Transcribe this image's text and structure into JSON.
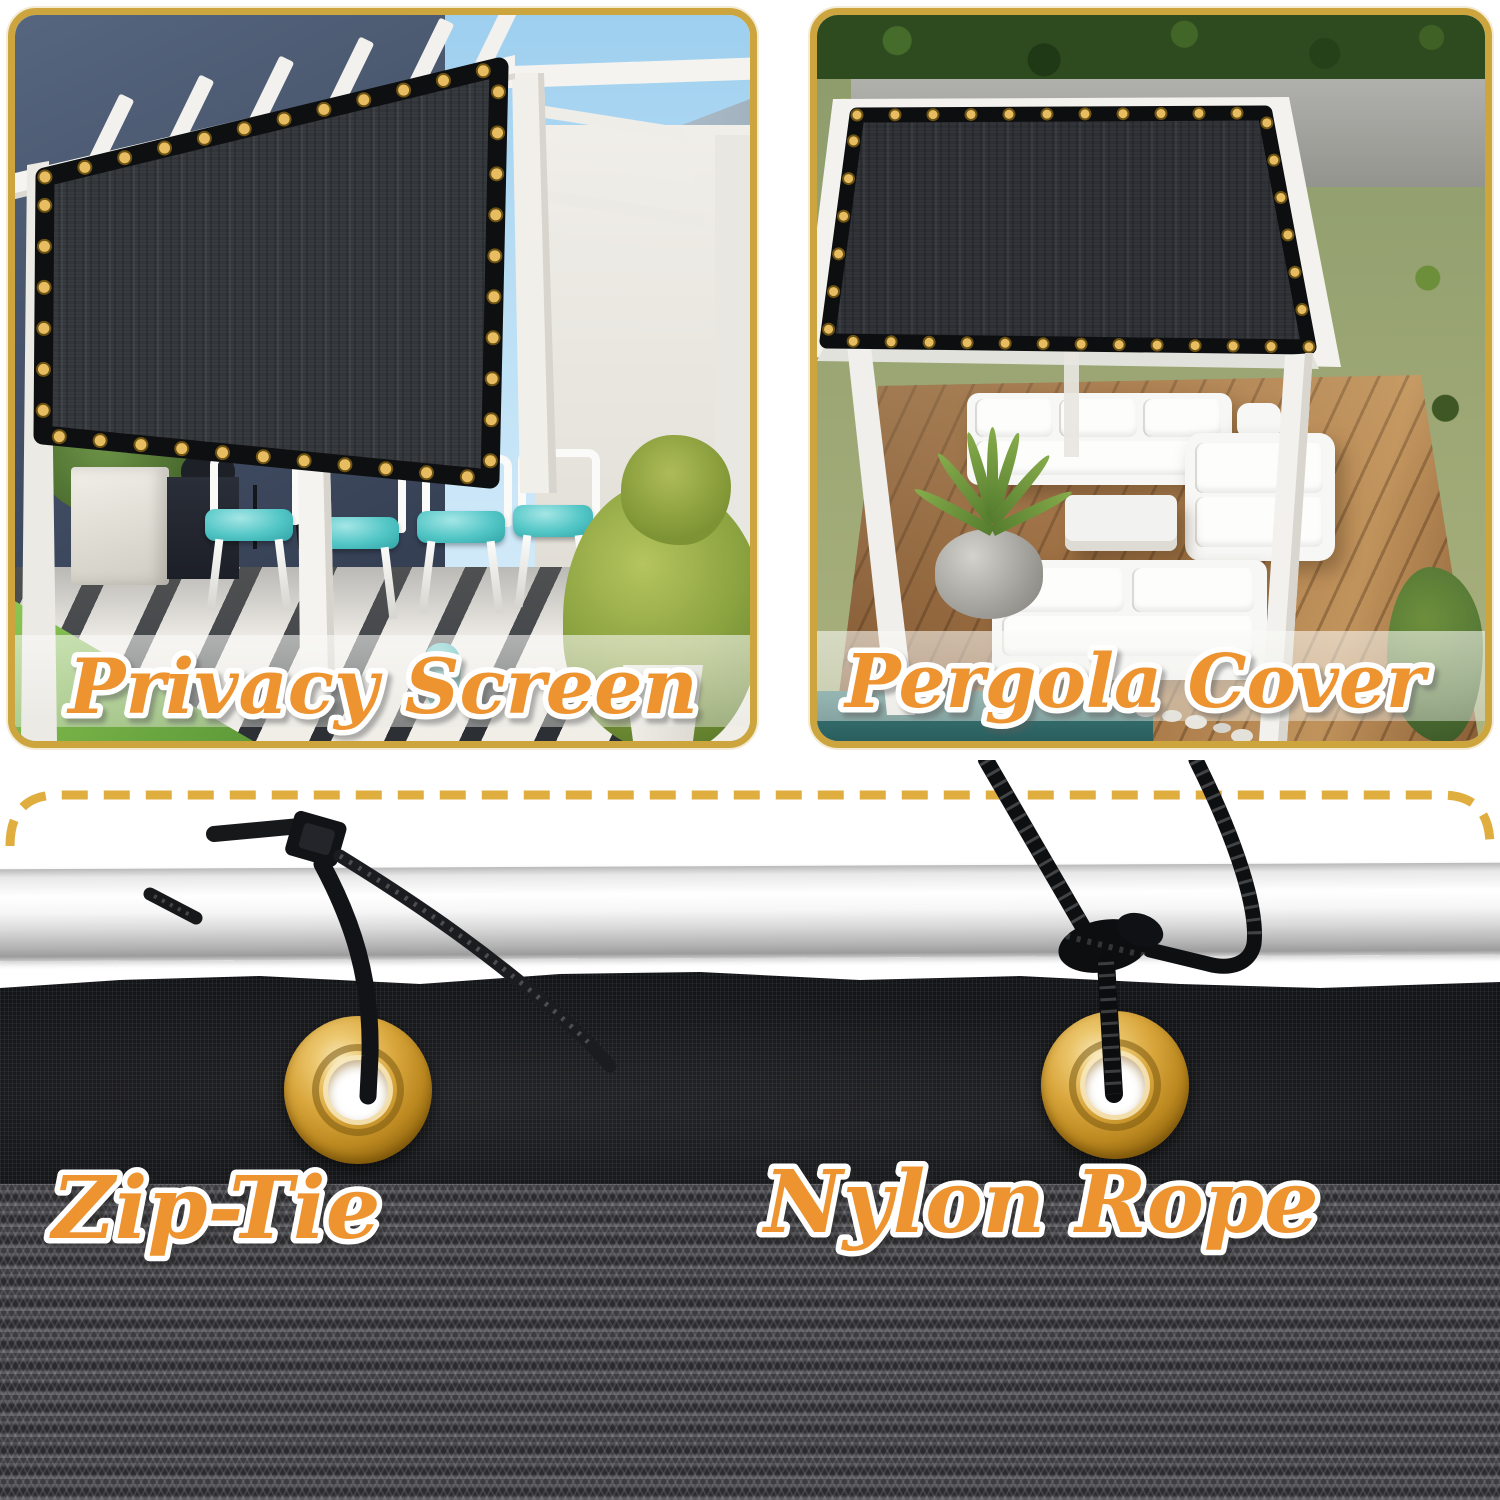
{
  "image": {
    "description": "Shade cloth product collage: two usage photos and mounting hardware close-up"
  },
  "panels": {
    "privacy_screen": {
      "caption": "Privacy Screen"
    },
    "pergola_cover": {
      "caption": "Pergola Cover"
    }
  },
  "hardware": {
    "zip_tie": "Zip-Tie",
    "nylon_rope": "Nylon Rope"
  },
  "colors": {
    "label_orange": "#ED9431",
    "label_outline": "#FFFFFF",
    "panel_border_gold": "#CDA53F",
    "dashed_line_gold": "#DFAE3F",
    "grommet_brass": "#D9A63C",
    "mesh_charcoal": "#34373C",
    "cushion_teal": "#53C6C6",
    "deck_wood": "#9B6C3F"
  }
}
